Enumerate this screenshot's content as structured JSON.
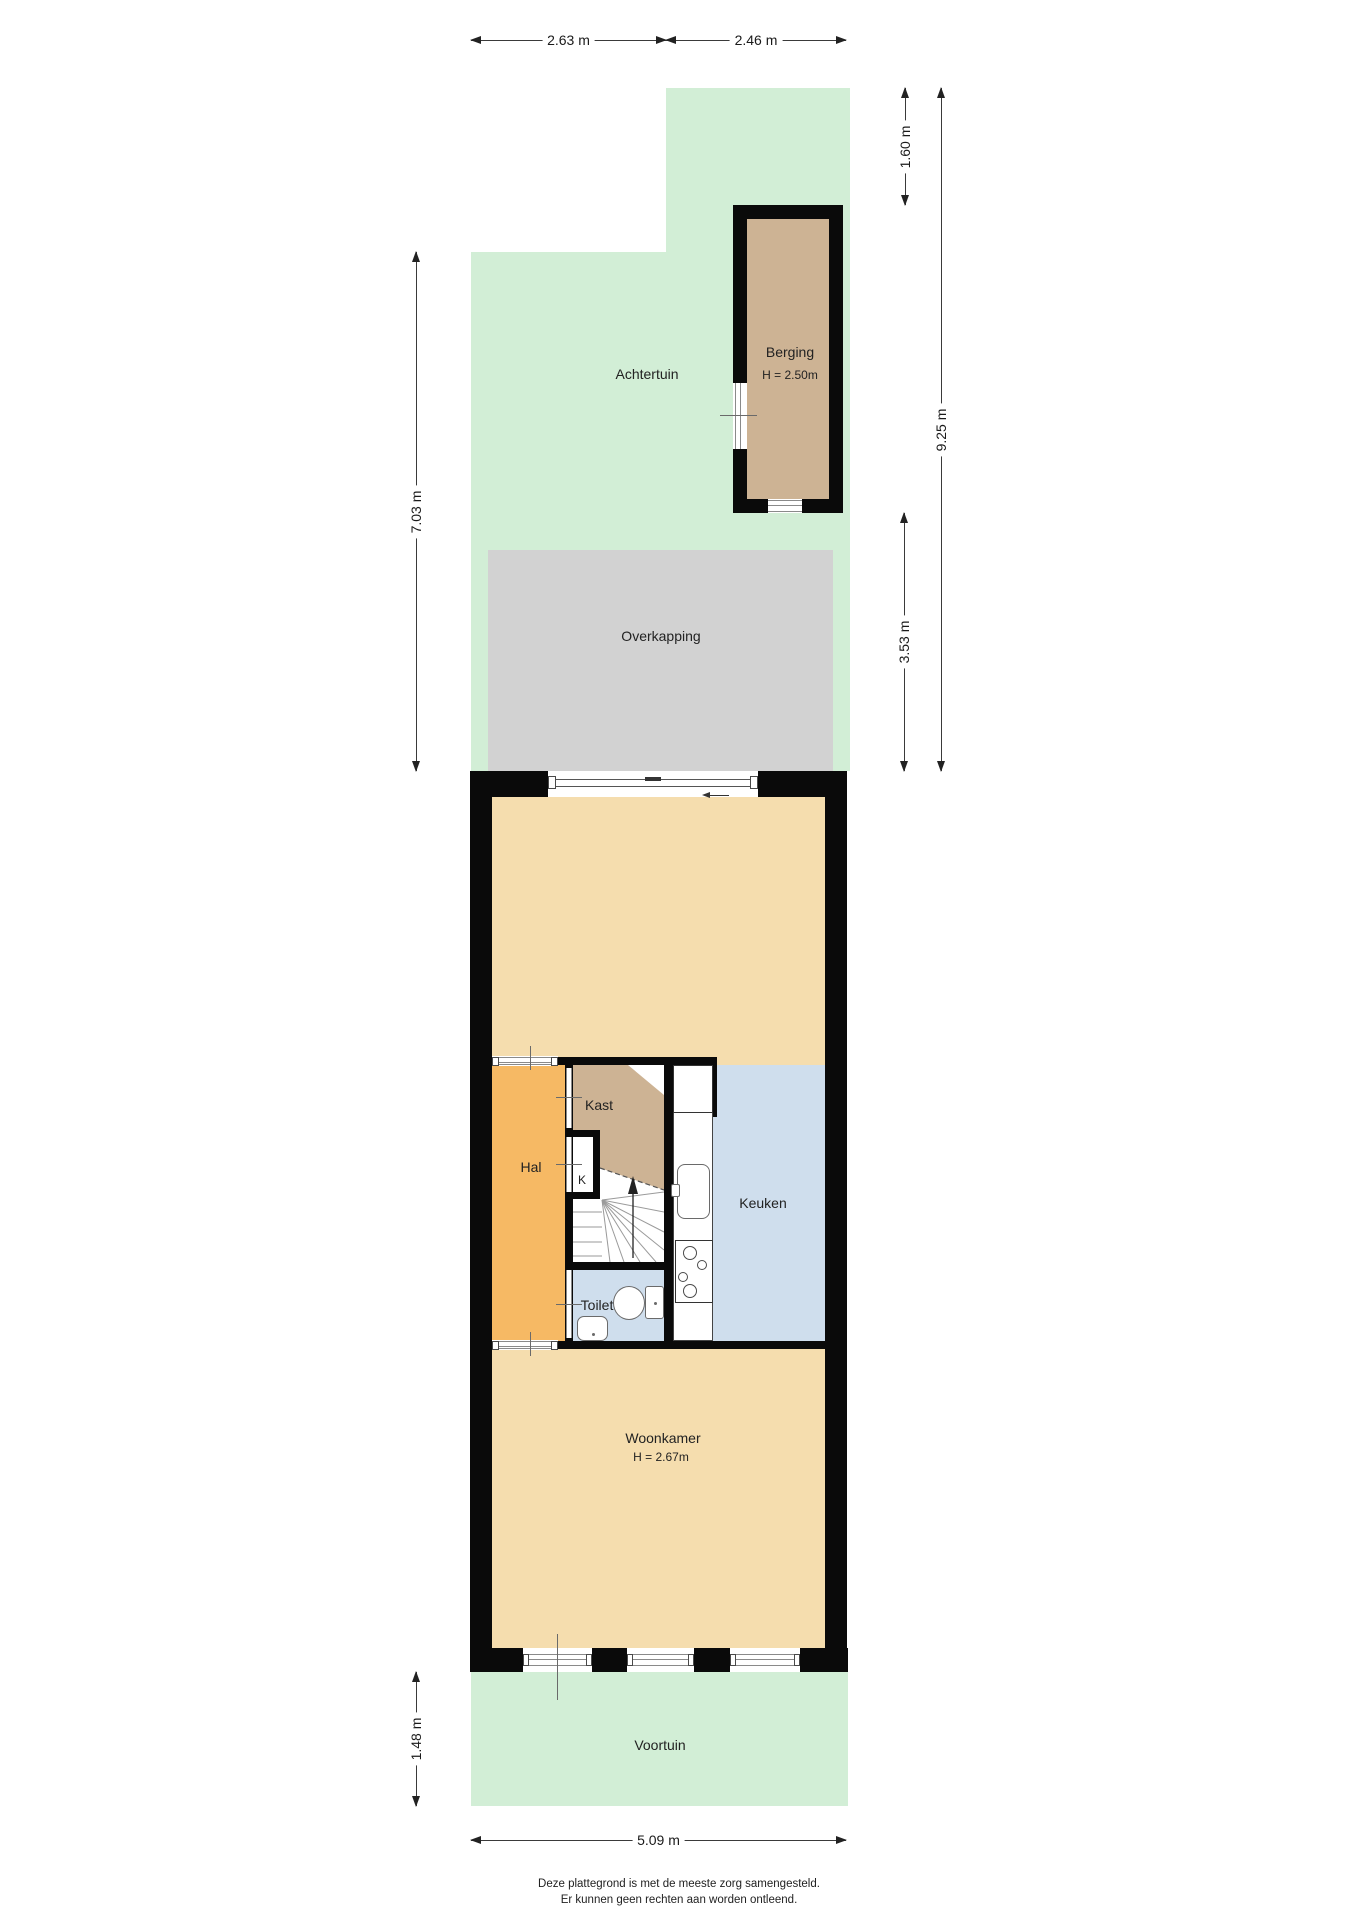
{
  "plan": {
    "type": "floorplan",
    "dimensions": {
      "top_left": "2.63 m",
      "top_right": "2.46 m",
      "right_upper": "1.60 m",
      "right_full": "9.25 m",
      "right_lower": "3.53 m",
      "left_upper": "7.03 m",
      "left_lower": "1.48 m",
      "bottom": "5.09 m"
    },
    "rooms": {
      "achtertuin": "Achtertuin",
      "berging": "Berging",
      "berging_height": "H = 2.50m",
      "overkapping": "Overkapping",
      "hal": "Hal",
      "kast": "Kast",
      "k": "K",
      "keuken": "Keuken",
      "toilet": "Toilet",
      "woonkamer": "Woonkamer",
      "woonkamer_height": "H = 2.67m",
      "voortuin": "Voortuin"
    },
    "disclaimer": {
      "line1": "Deze plattegrond is met de meeste zorg samengesteld.",
      "line2": "Er kunnen geen rechten aan worden ontleend."
    },
    "colors": {
      "garden_green": "#d2eed6",
      "canopy_gray": "#d2d2d2",
      "room_beige": "#f5ddae",
      "hall_orange": "#f6b964",
      "closet_tan": "#cdb394",
      "kitchen_blue": "#cfdeed",
      "wall_black": "#0a0a0a"
    }
  }
}
